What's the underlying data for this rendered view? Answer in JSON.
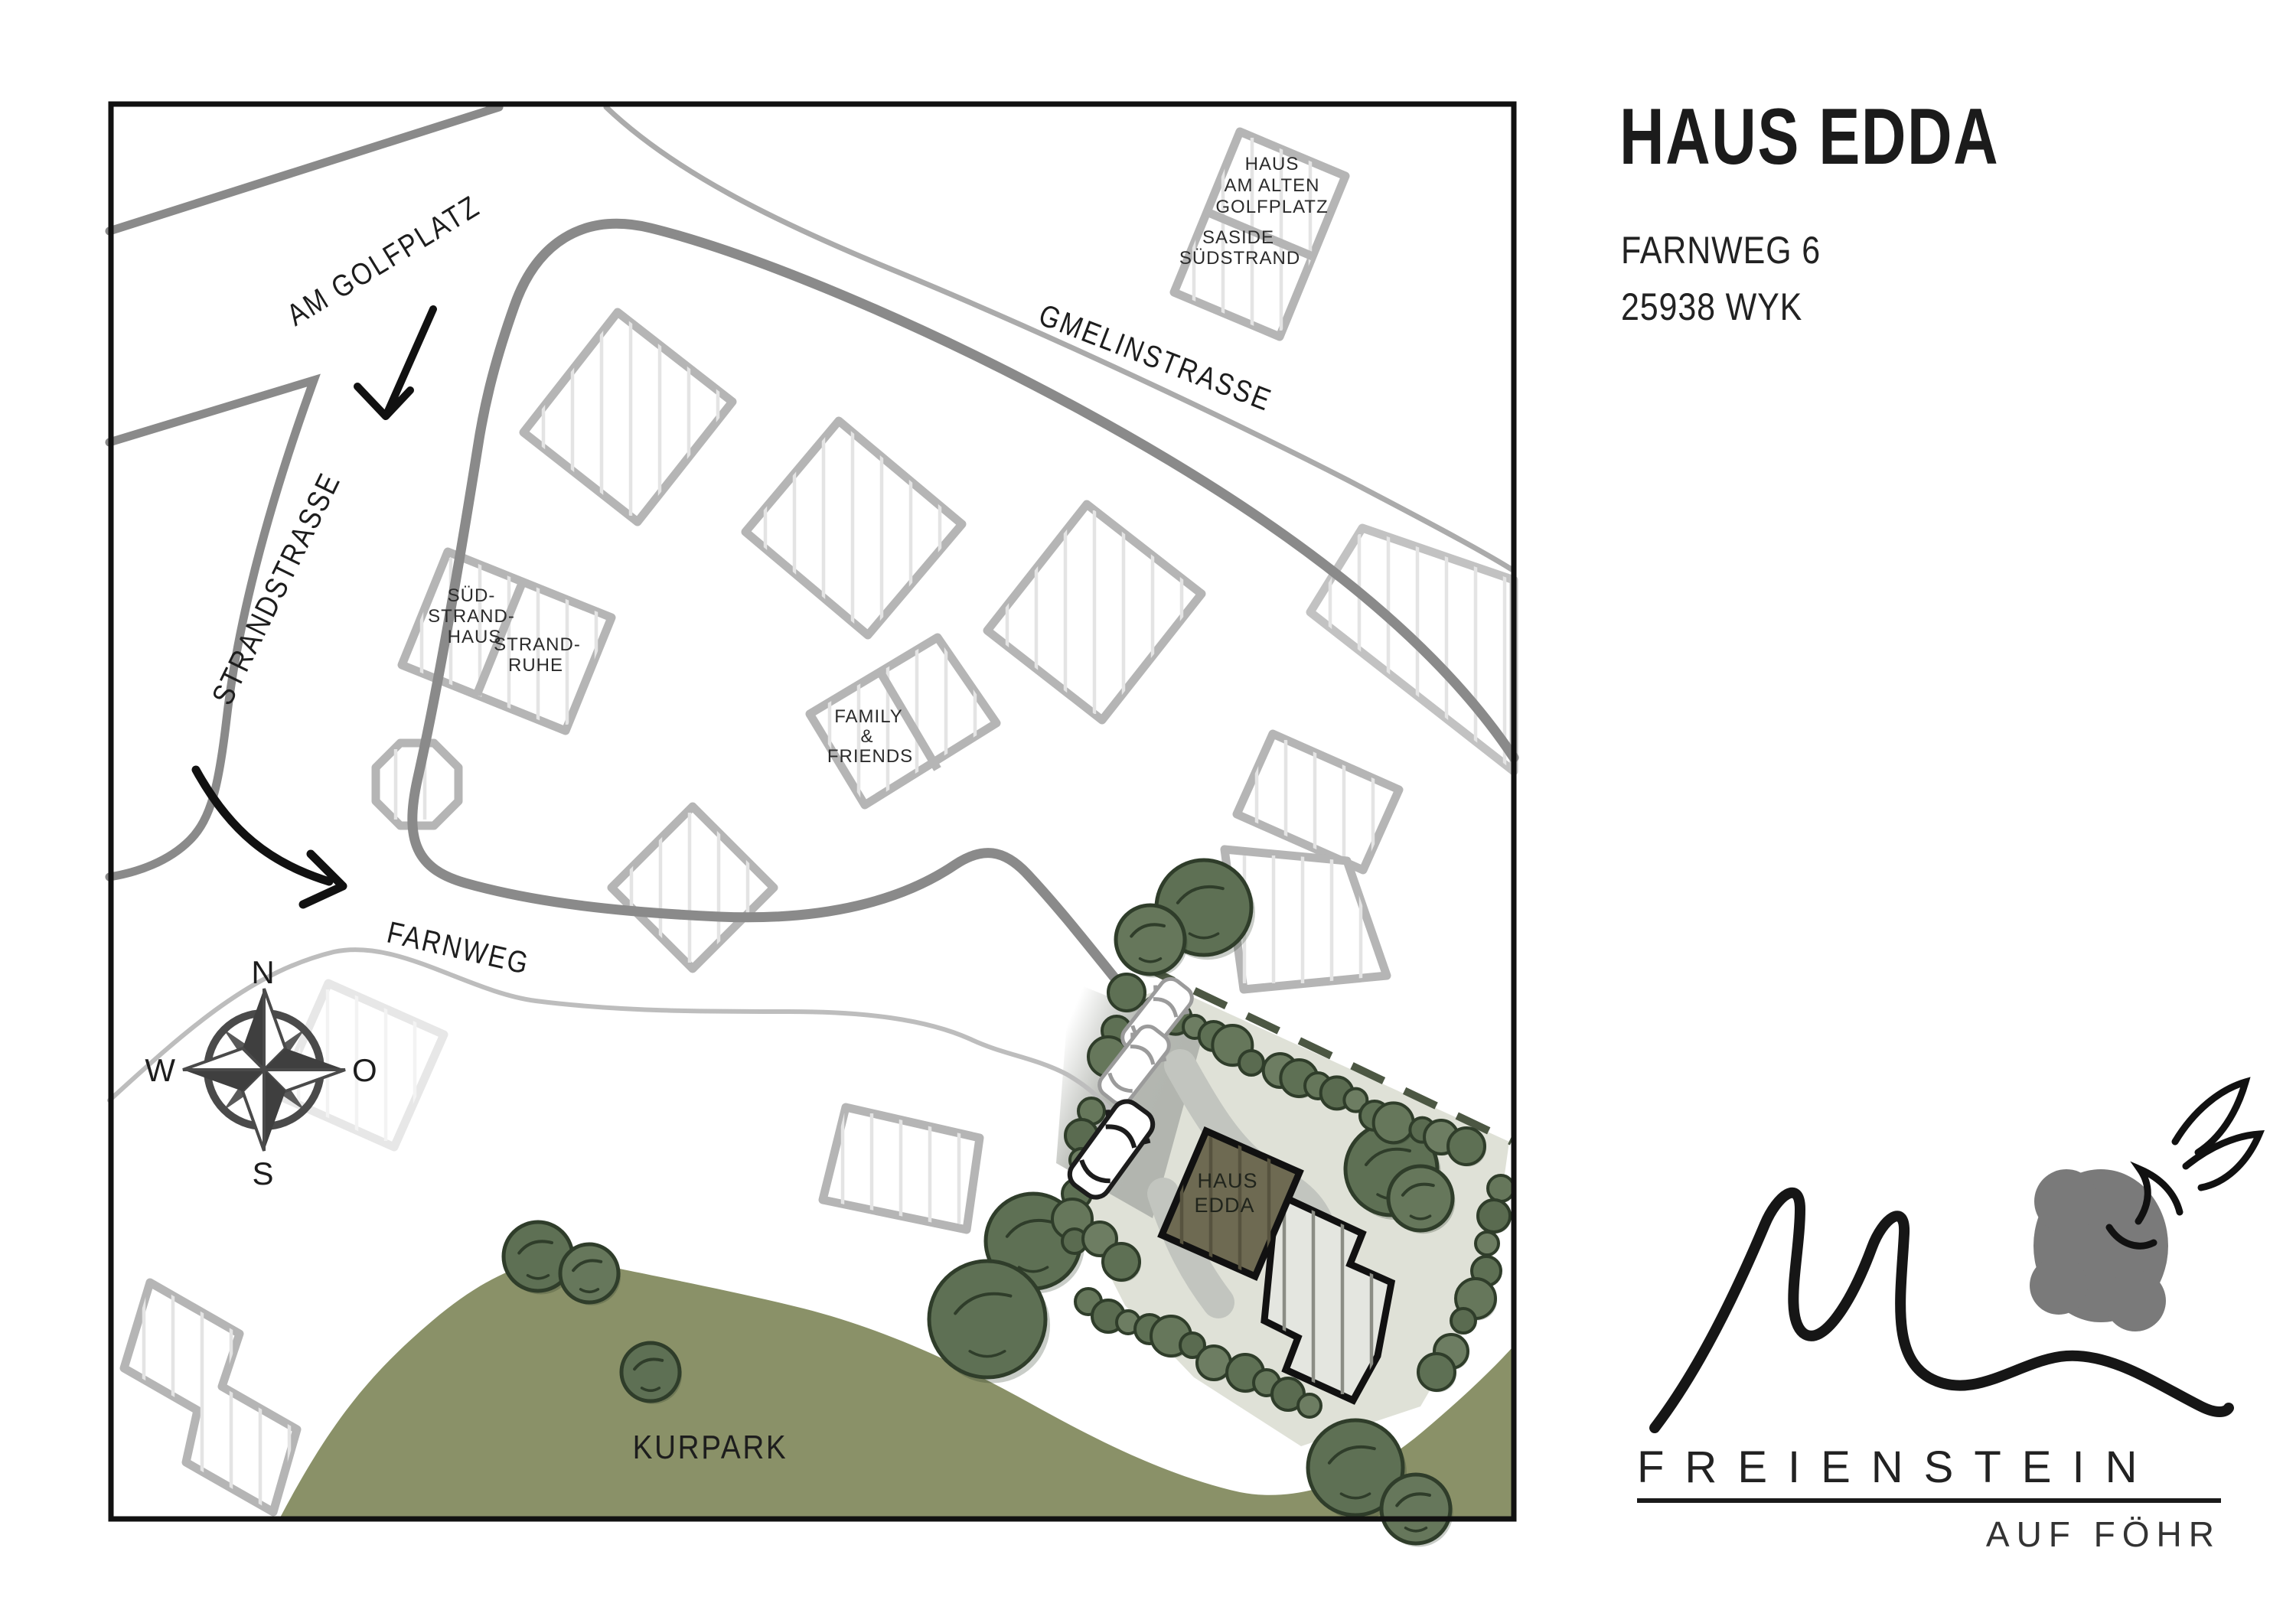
{
  "header": {
    "title": "HAUS EDDA",
    "address_line1": "FARNWEG 6",
    "address_line2": "25938 WYK"
  },
  "logo": {
    "brand": "FREIENSTEIN",
    "tagline": "AUF FÖHR"
  },
  "map": {
    "streets": {
      "am_golfplatz": "AM GOLFPLATZ",
      "strandstrasse": "STRANDSTRASSE",
      "gmelinstrasse": "GMELINSTRASSE",
      "farnweg": "FARNWEG"
    },
    "areas": {
      "kurpark": "KURPARK"
    },
    "compass": {
      "n": "N",
      "e": "O",
      "s": "S",
      "w": "W"
    },
    "buildings": {
      "haus_am_alten_golfplatz": {
        "lines": [
          "HAUS",
          "AM ALTEN",
          "GOLFPLATZ"
        ]
      },
      "saside_suedstrand": {
        "lines": [
          "SASIDE",
          "SÜDSTRAND"
        ]
      },
      "sued_strand_haus": {
        "lines": [
          "SÜD-",
          "STRAND-",
          "HAUS"
        ]
      },
      "strand_ruhe": {
        "lines": [
          "STRAND-",
          "RUHE"
        ]
      },
      "family_friends": {
        "lines": [
          "FAMILY",
          "&",
          "FRIENDS"
        ]
      },
      "haus_edda": {
        "lines": [
          "HAUS",
          "EDDA"
        ]
      }
    },
    "colors": {
      "park_green": "#8a9168",
      "tree_green": "#5e7054",
      "parcel": "#dfe1d7",
      "street_gray": "#8a8a8a",
      "house_fill": "#6e6a52",
      "boundary_dash": "#4c5743"
    }
  }
}
